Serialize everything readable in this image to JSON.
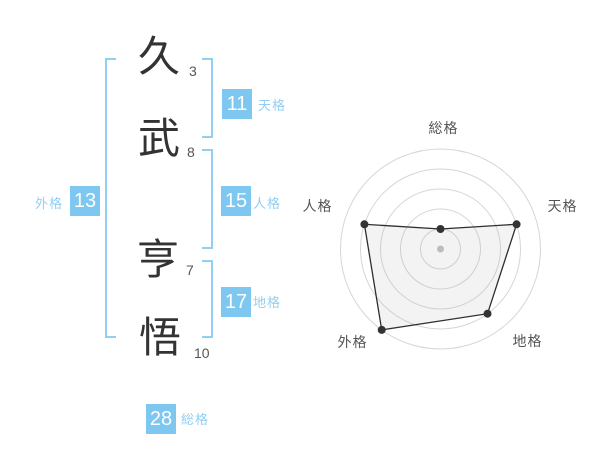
{
  "colors": {
    "badge_blue": "#7dc7f0",
    "accent_light": "#92cff2",
    "kanji_ink": "#333333",
    "muted_text": "#555555"
  },
  "name_analysis": {
    "chars": [
      {
        "char": "久",
        "strokes": "3"
      },
      {
        "char": "武",
        "strokes": "8"
      },
      {
        "char": "亨",
        "strokes": "7"
      },
      {
        "char": "悟",
        "strokes": "10"
      }
    ],
    "badges": {
      "tenkaku": {
        "value": "11",
        "label": "天格"
      },
      "jinkaku": {
        "value": "15",
        "label": "人格"
      },
      "chikaku": {
        "value": "17",
        "label": "地格"
      },
      "gaikaku": {
        "value": "13",
        "label": "外格"
      },
      "soukaku": {
        "value": "28",
        "label": "総格"
      }
    }
  },
  "chart_data": {
    "type": "radar",
    "categories": [
      "総格",
      "天格",
      "地格",
      "外格",
      "人格"
    ],
    "values": [
      1,
      4,
      4,
      5,
      4
    ],
    "max": 5,
    "rings": 5,
    "grid": "circular-no-spokes",
    "legend": false,
    "title": "",
    "colors": {
      "line": "#2e2e2e",
      "point": "#333333",
      "fill": "rgba(160,160,160,0.13)",
      "grid": "#d6d6d6",
      "center_dot": "#bdbdbd",
      "label": "#555555"
    }
  }
}
